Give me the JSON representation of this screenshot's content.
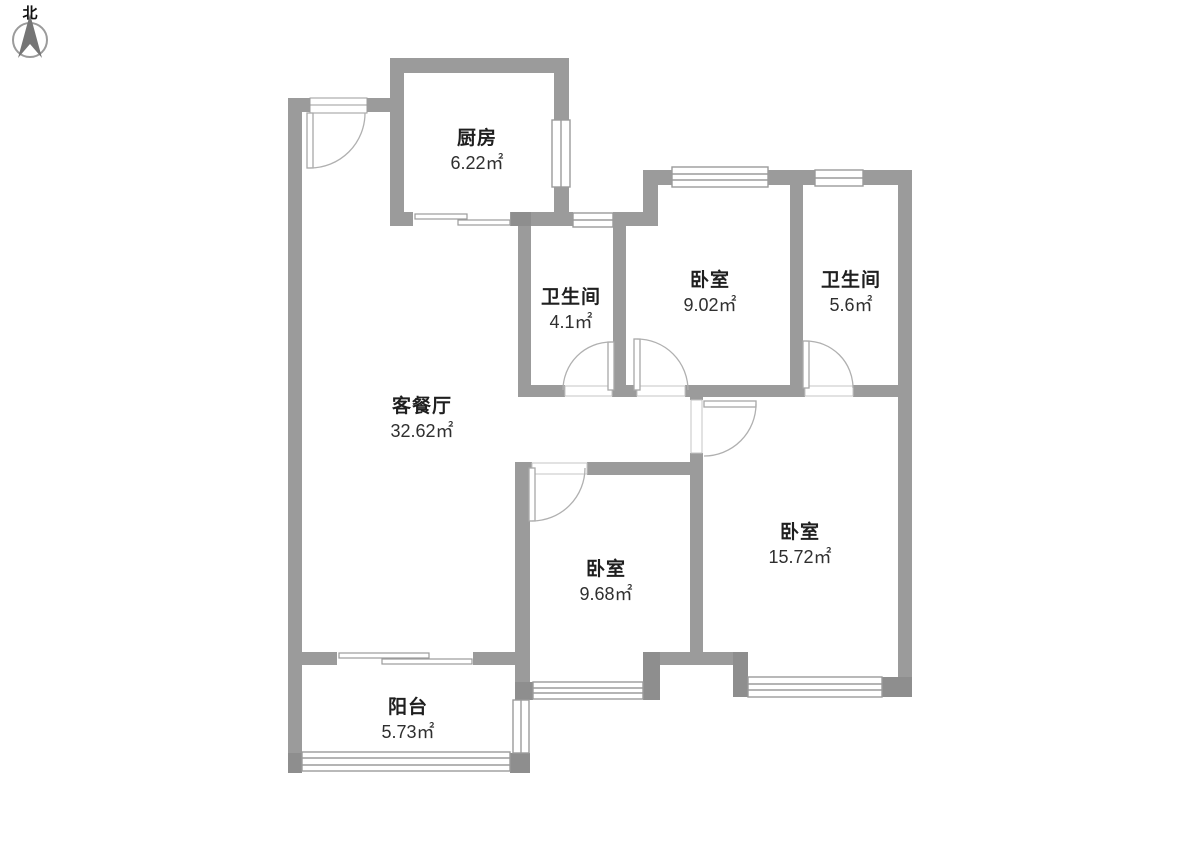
{
  "document": {
    "kind": "apartment-floor-plan",
    "background": "#ffffff"
  },
  "compass": {
    "label": "北"
  },
  "rooms": [
    {
      "id": "kitchen",
      "name": "厨房",
      "area": "6.22㎡"
    },
    {
      "id": "bathroom-small",
      "name": "卫生间",
      "area": "4.1㎡"
    },
    {
      "id": "bedroom-north",
      "name": "卧室",
      "area": "9.02㎡"
    },
    {
      "id": "bathroom-east",
      "name": "卫生间",
      "area": "5.6㎡"
    },
    {
      "id": "living-dining",
      "name": "客餐厅",
      "area": "32.62㎡"
    },
    {
      "id": "bedroom-east",
      "name": "卧室",
      "area": "15.72㎡"
    },
    {
      "id": "bedroom-middle",
      "name": "卧室",
      "area": "9.68㎡"
    },
    {
      "id": "balcony",
      "name": "阳台",
      "area": "5.73㎡"
    }
  ],
  "colors": {
    "wall": "#9b9b9b",
    "wall_block": "#8e8e8e",
    "window_stroke": "#9b9b9b",
    "door_arc": "#b0b0b0",
    "threshold_stroke": "#c4c4c4",
    "text": "#1f1f1f"
  }
}
